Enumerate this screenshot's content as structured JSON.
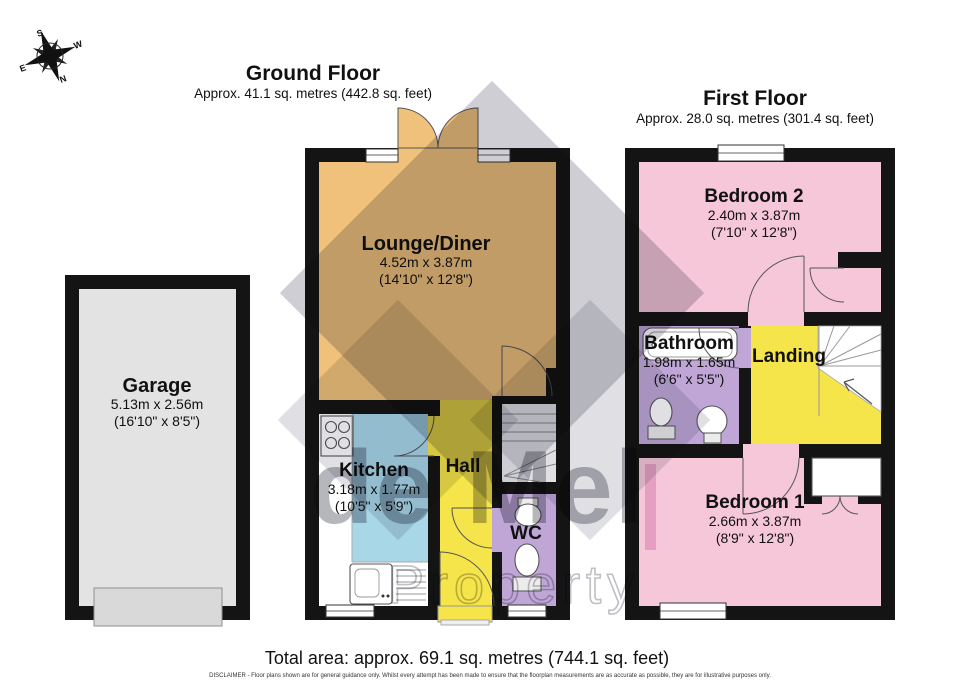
{
  "compass": {
    "n": "N",
    "s": "S",
    "e": "E",
    "w": "W"
  },
  "floors": {
    "ground": {
      "title": "Ground Floor",
      "area": "Approx. 41.1 sq. metres (442.8 sq. feet)"
    },
    "first": {
      "title": "First Floor",
      "area": "Approx. 28.0 sq. metres (301.4 sq. feet)"
    }
  },
  "rooms": {
    "garage": {
      "name": "Garage",
      "metric": "5.13m x 2.56m",
      "imperial": "(16'10\" x 8'5\")"
    },
    "lounge": {
      "name": "Lounge/Diner",
      "metric": "4.52m x 3.87m",
      "imperial": "(14'10\" x 12'8\")"
    },
    "kitchen": {
      "name": "Kitchen",
      "metric": "3.18m x 1.77m",
      "imperial": "(10'5\" x 5'9\")"
    },
    "hall": {
      "name": "Hall"
    },
    "wc": {
      "name": "WC"
    },
    "bedroom2": {
      "name": "Bedroom 2",
      "metric": "2.40m x 3.87m",
      "imperial": "(7'10\" x 12'8\")"
    },
    "bathroom": {
      "name": "Bathroom",
      "metric": "1.98m x 1.65m",
      "imperial": "(6'6\" x 5'5\")"
    },
    "landing": {
      "name": "Landing"
    },
    "bedroom1": {
      "name": "Bedroom 1",
      "metric": "2.66m x 3.87m",
      "imperial": "(8'9\" x 12'8\")"
    }
  },
  "footer": {
    "total_area": "Total area: approx. 69.1 sq. metres (744.1 sq. feet)",
    "disclaimer": "DISCLAIMER -  Floor plans shown are for general guidance only. Whilst every attempt has been made to ensure that the floorplan measurements are as accurate as possible, they are for illustrative purposes only."
  },
  "watermark": {
    "line1": "de Mel",
    "line2": "Property"
  },
  "colors": {
    "wall": "#141414",
    "lounge": "#f0c17a",
    "kitchen": "#a8d8e8",
    "hall": "#f5e44a",
    "wc_bath": "#bfa6d6",
    "bedroom": "#f6c7d9",
    "garage": "#e3e3e4",
    "watermark_gray": "#9b9ba3"
  }
}
